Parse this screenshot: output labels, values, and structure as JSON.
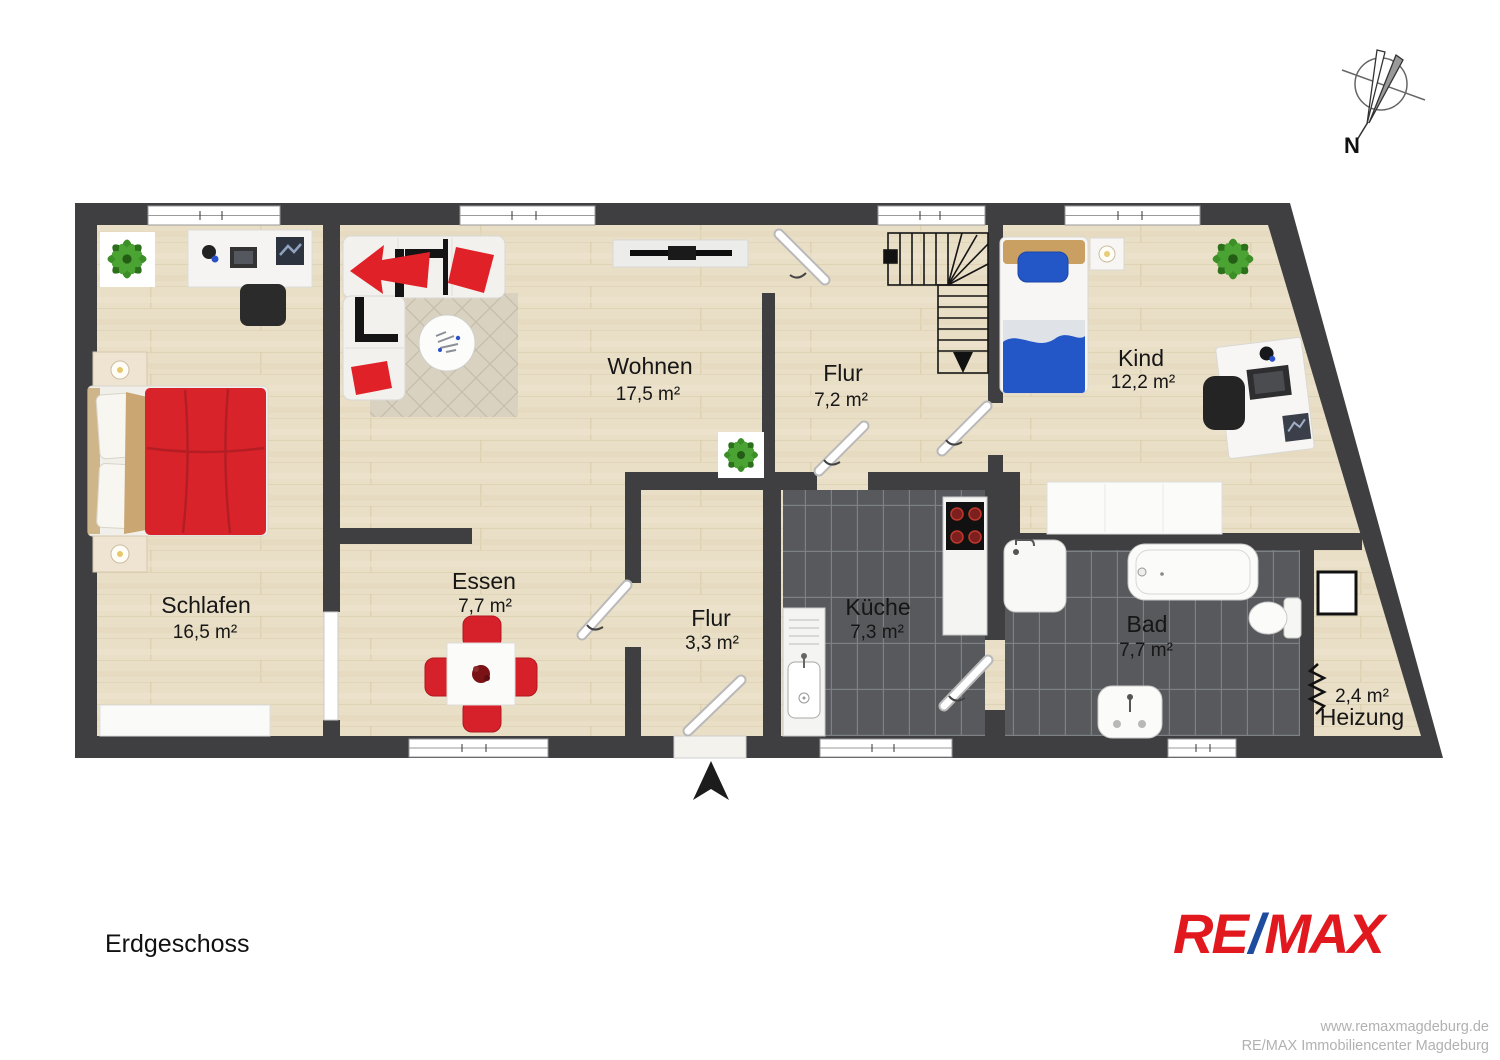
{
  "plan": {
    "floor_label": "Erdgeschoss",
    "compass": {
      "label": "N"
    },
    "rooms": [
      {
        "name": "Schlafen",
        "area": "16,5 m²"
      },
      {
        "name": "Wohnen",
        "area": "17,5 m²"
      },
      {
        "name": "Essen",
        "area": "7,7 m²"
      },
      {
        "name": "Flur",
        "area": "7,2 m²"
      },
      {
        "name": "Kind",
        "area": "12,2 m²"
      },
      {
        "name": "Flur",
        "area": "3,3 m²"
      },
      {
        "name": "Küche",
        "area": "7,3 m²"
      },
      {
        "name": "Bad",
        "area": "7,7 m²"
      },
      {
        "name": "Heizung",
        "area": "2,4 m²"
      }
    ],
    "colors": {
      "wall": "#3f3f41",
      "floor": "#e8ddc4",
      "tile": "#57595c",
      "bed_red": "#d8232a",
      "kid_blue": "#2356c6"
    }
  },
  "branding": {
    "logo": {
      "re": "RE",
      "slash": "/",
      "max": "MAX",
      "red": "#e1191f",
      "blue": "#1f4b9e"
    }
  },
  "footer": {
    "line1": "www.remaxmagdeburg.de",
    "line2": "RE/MAX Immobiliencenter Magdeburg"
  }
}
